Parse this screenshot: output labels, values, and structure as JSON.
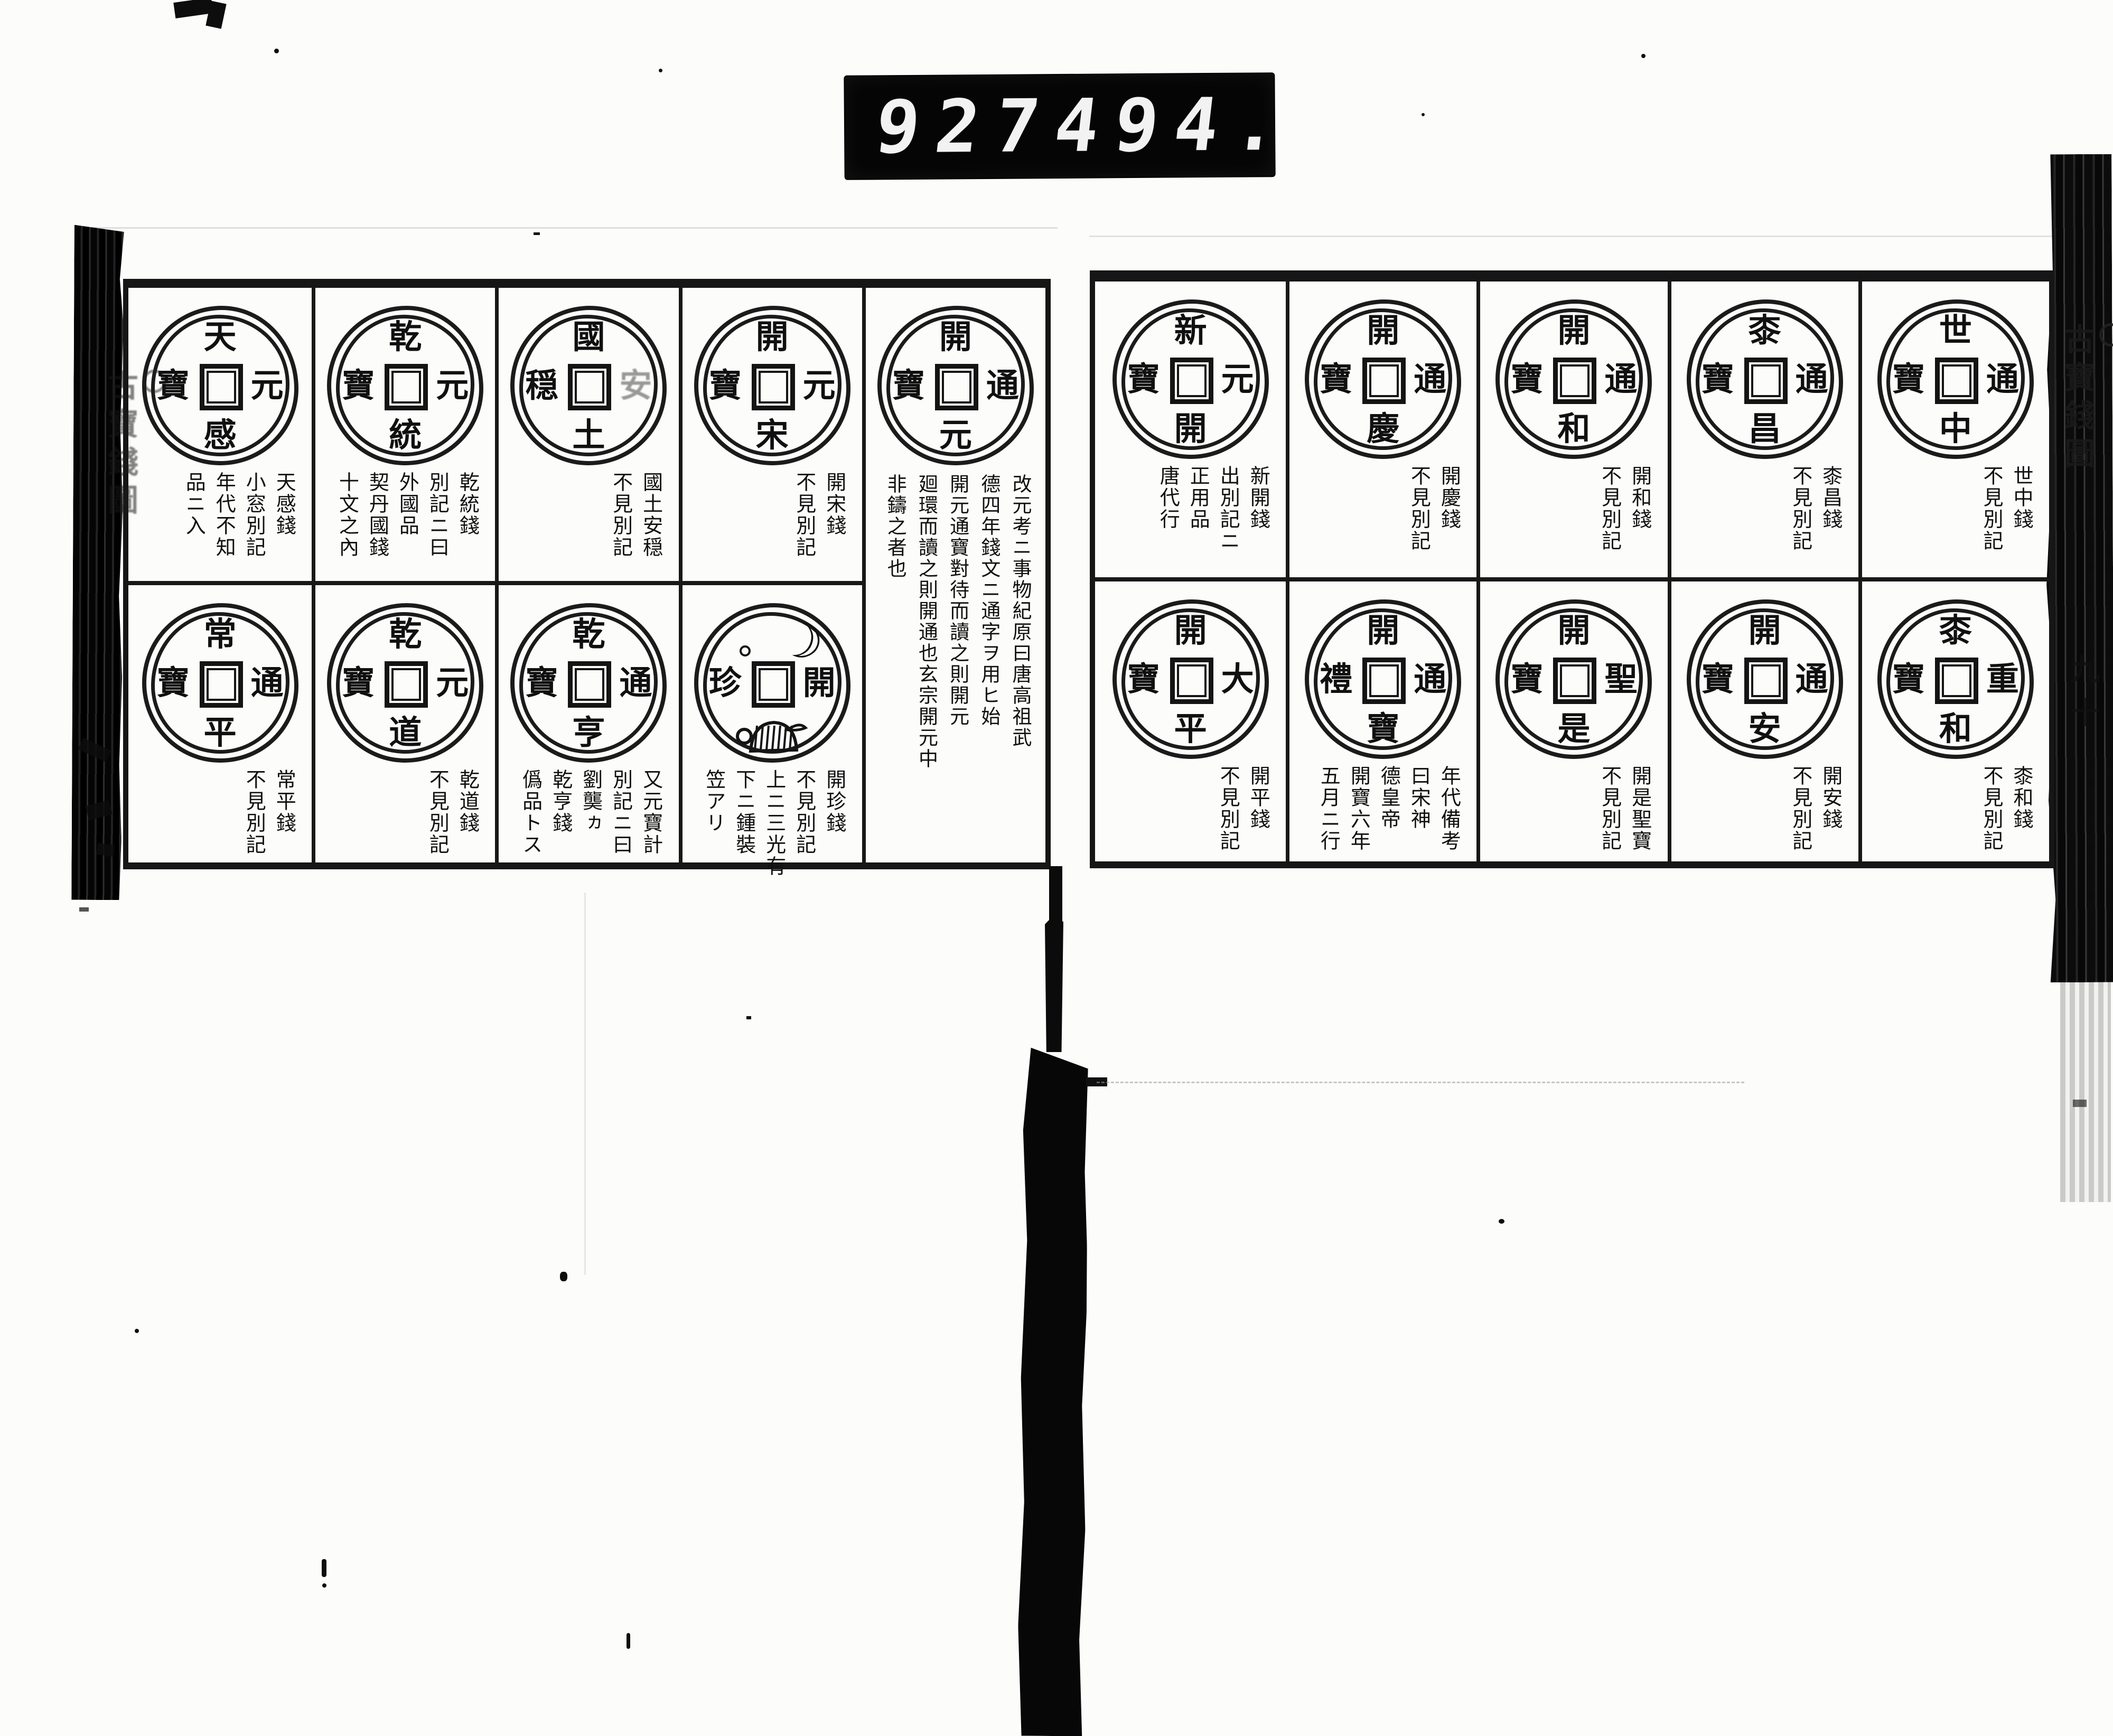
{
  "frame_counter": {
    "group1": "927",
    "group2": "494."
  },
  "running_title": "古寶錢圖",
  "margin_left": {
    "mark": "circle",
    "title": "古寶錢圖"
  },
  "margin_right": {
    "mark": "circle",
    "title": "古寶錢圖",
    "page_marks": "九十"
  },
  "left_page": {
    "row1": [
      {
        "coin": {
          "top": "天",
          "right": "元",
          "bottom": "感",
          "left": "寶"
        },
        "notes": [
          "天感錢",
          "小窓別記",
          "年代不知",
          "品ニ入"
        ]
      },
      {
        "coin": {
          "top": "乾",
          "right": "元",
          "bottom": "統",
          "left": "寶"
        },
        "notes": [
          "乾統錢",
          "別記ニ曰",
          "外國品",
          "契丹國錢",
          "十文之內"
        ]
      },
      {
        "coin": {
          "top": "國",
          "right": "安",
          "bottom": "土",
          "left": "穏",
          "faint": [
            "right"
          ]
        },
        "notes": [
          "國土安穏",
          "不見別記"
        ]
      },
      {
        "coin": {
          "top": "開",
          "right": "元",
          "bottom": "宋",
          "left": "寶"
        },
        "notes": [
          "開宋錢",
          "不見別記"
        ]
      }
    ],
    "row2": [
      {
        "coin": {
          "top": "常",
          "right": "通",
          "bottom": "平",
          "left": "寶"
        },
        "notes": [
          "常平錢",
          "不見別記"
        ]
      },
      {
        "coin": {
          "top": "乾",
          "right": "元",
          "bottom": "道",
          "left": "寶"
        },
        "notes": [
          "乾道錢",
          "不見別記"
        ]
      },
      {
        "coin": {
          "top": "乾",
          "right": "通",
          "bottom": "亨",
          "left": "寶"
        },
        "notes": [
          "又元寶計",
          "別記ニ曰",
          "劉龑ヵ",
          "乾亨錢",
          "僞品トス"
        ]
      },
      {
        "coin": {
          "top": "",
          "right": "開",
          "bottom": "",
          "left": "珍",
          "pictorial": {
            "top": "crescent-moon-and-star",
            "bottom": "bell-with-hat"
          }
        },
        "notes": [
          "開珍錢",
          "不見別記",
          "上ニ三光有",
          "下ニ鍾裝",
          "笠アリ"
        ]
      }
    ],
    "tall": {
      "coin": {
        "top": "開",
        "right": "通",
        "bottom": "元",
        "left": "寶"
      },
      "notes": [
        "改元考ニ事物紀原曰唐高祖武",
        "德四年錢文ニ通字ヲ用ヒ始",
        "開元通寶對待而讀之則開元",
        "廻環而讀之則開通也玄宗開元中",
        "非鑄之者也"
      ]
    }
  },
  "right_page": {
    "row1": [
      {
        "coin": {
          "top": "新",
          "right": "元",
          "bottom": "開",
          "left": "寶"
        },
        "notes": [
          "新開錢",
          "出別記ニ",
          "正用品",
          "唐代行"
        ]
      },
      {
        "coin": {
          "top": "開",
          "right": "通",
          "bottom": "慶",
          "left": "寶"
        },
        "notes": [
          "開慶錢",
          "不見別記"
        ]
      },
      {
        "coin": {
          "top": "開",
          "right": "通",
          "bottom": "和",
          "left": "寶"
        },
        "notes": [
          "開和錢",
          "不見別記"
        ]
      },
      {
        "coin": {
          "top": "桼",
          "right": "通",
          "bottom": "昌",
          "left": "寶"
        },
        "notes": [
          "桼昌錢",
          "不見別記"
        ]
      },
      {
        "coin": {
          "top": "世",
          "right": "通",
          "bottom": "中",
          "left": "寶"
        },
        "notes": [
          "世中錢",
          "不見別記"
        ]
      }
    ],
    "row2": [
      {
        "coin": {
          "top": "開",
          "right": "大",
          "bottom": "平",
          "left": "寶"
        },
        "notes": [
          "開平錢",
          "不見別記"
        ]
      },
      {
        "coin": {
          "top": "開",
          "right": "通",
          "bottom": "寶",
          "left": "禮"
        },
        "notes": [
          "年代備考",
          "曰宋神",
          "德皇帝",
          "開寶六年",
          "五月ニ行"
        ]
      },
      {
        "coin": {
          "top": "開",
          "right": "聖",
          "bottom": "是",
          "left": "寶"
        },
        "notes": [
          "開是聖寶",
          "不見別記"
        ]
      },
      {
        "coin": {
          "top": "開",
          "right": "通",
          "bottom": "安",
          "left": "寶"
        },
        "notes": [
          "開安錢",
          "不見別記"
        ]
      },
      {
        "coin": {
          "top": "桼",
          "right": "重",
          "bottom": "和",
          "left": "寶"
        },
        "notes": [
          "桼和錢",
          "不見別記"
        ]
      }
    ]
  }
}
